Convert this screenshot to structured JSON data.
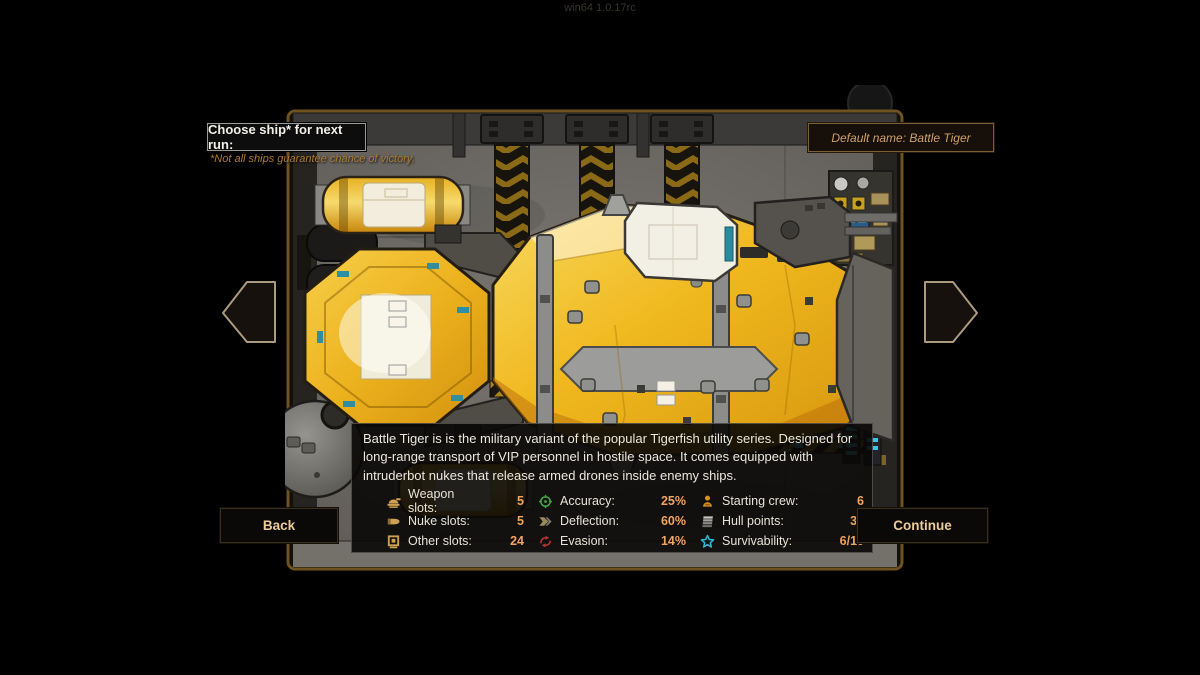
{
  "window": {
    "version_text": "win64 1.0.17rc"
  },
  "header": {
    "choose_label": "Choose ship* for next run:",
    "disclaimer": "*Not all ships guarantee chance of victory.",
    "default_name": "Default name: Battle Tiger"
  },
  "ship": {
    "name": "Battle Tiger",
    "description": "Battle Tiger is is the military variant of the popular Tigerfish utility series. Designed for long-range transport of VIP personnel in hostile space. It comes equipped with intruderbot nukes that release armed drones inside enemy ships."
  },
  "stats": {
    "columns": [
      {
        "items": [
          {
            "icon": "weapon-slots-icon",
            "label": "Weapon slots:",
            "value": "5"
          },
          {
            "icon": "nuke-slots-icon",
            "label": "Nuke slots:",
            "value": "5"
          },
          {
            "icon": "other-slots-icon",
            "label": "Other slots:",
            "value": "24"
          }
        ]
      },
      {
        "items": [
          {
            "icon": "accuracy-icon",
            "label": "Accuracy:",
            "value": "25%"
          },
          {
            "icon": "deflection-icon",
            "label": "Deflection:",
            "value": "60%"
          },
          {
            "icon": "evasion-icon",
            "label": "Evasion:",
            "value": "14%"
          }
        ]
      },
      {
        "items": [
          {
            "icon": "starting-crew-icon",
            "label": "Starting crew:",
            "value": "6"
          },
          {
            "icon": "hull-points-icon",
            "label": "Hull points:",
            "value": "30"
          },
          {
            "icon": "survivability-icon",
            "label": "Survivability:",
            "value": "6/10"
          }
        ]
      }
    ]
  },
  "buttons": {
    "back": "Back",
    "continue": "Continue"
  },
  "colors": {
    "stat_value": "#f2a35c",
    "accuracy_icon": "#43a843",
    "evasion_icon": "#b43434",
    "survivability_icon": "#2cb8dc",
    "crew_icon": "#d8921e",
    "slot_icons": "#c89a5a",
    "ship_hull_yellow": "#edb21e",
    "hangar_wall": "#6d6a66"
  }
}
